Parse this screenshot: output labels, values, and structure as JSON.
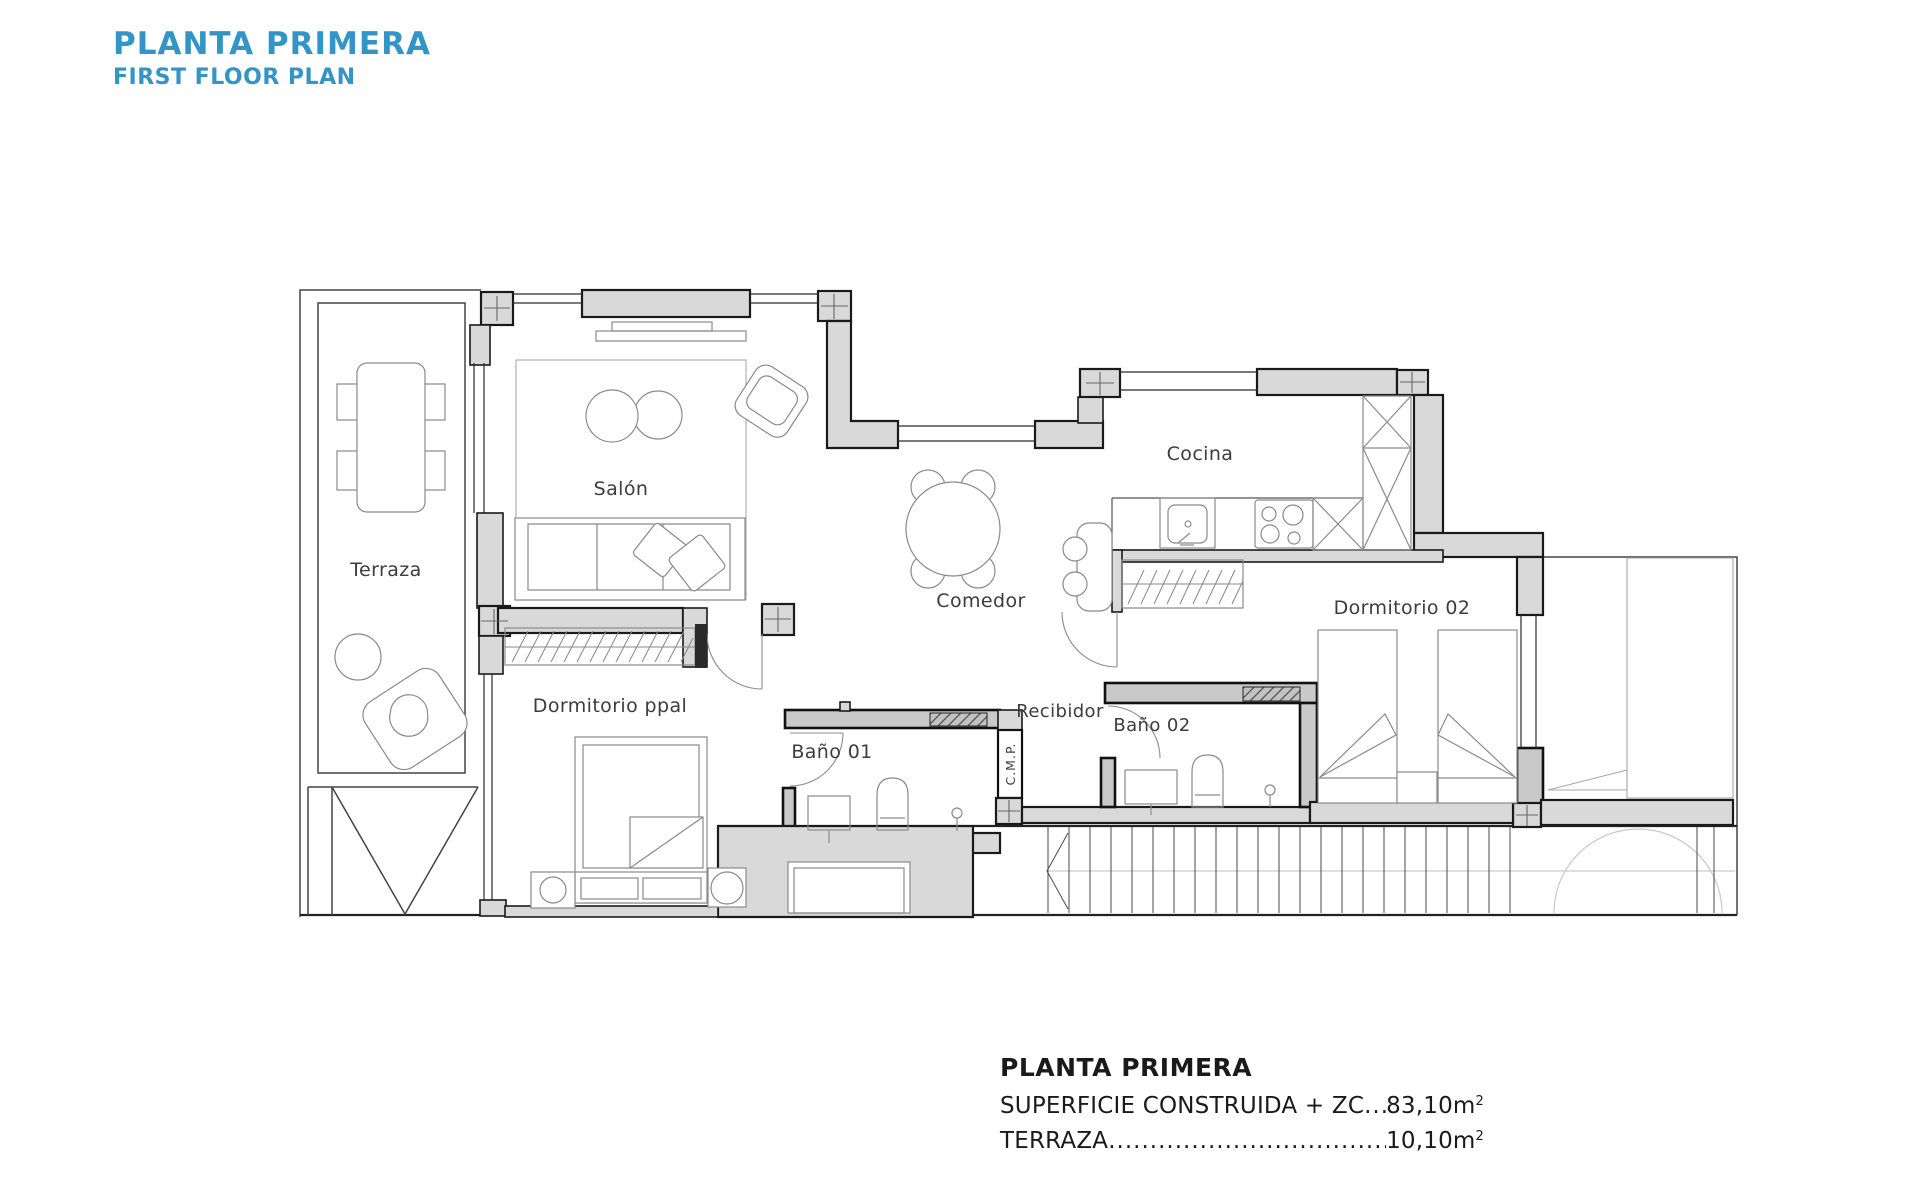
{
  "colors": {
    "accent_blue": "#3394c6",
    "wall_fill": "#d9d9d9",
    "wall_outline": "#1a1a1a",
    "paper": "#ffffff"
  },
  "header": {
    "title": "PLANTA PRIMERA",
    "subtitle": "FIRST FLOOR PLAN"
  },
  "plan": {
    "rooms": {
      "terraza": {
        "label": "Terraza"
      },
      "salon": {
        "label": "Salón"
      },
      "comedor": {
        "label": "Comedor"
      },
      "cocina": {
        "label": "Cocina"
      },
      "dormitorio02": {
        "label": "Dormitorio 02"
      },
      "dormitorioPpal": {
        "label": "Dormitorio ppal"
      },
      "bano01": {
        "label": "Baño 01"
      },
      "recibidor": {
        "label": "Recibidor"
      },
      "bano02": {
        "label": "Baño 02"
      },
      "cmp": {
        "label": "C.M.P."
      }
    }
  },
  "summary": {
    "title": "PLANTA PRIMERA",
    "rows": [
      {
        "label": "SUPERFICIE CONSTRUIDA + ZC",
        "dots": "................................................................................",
        "value": "83,10m",
        "unit_sup": "2"
      },
      {
        "label": "TERRAZA",
        "dots": "................................................................................",
        "value": "10,10m",
        "unit_sup": "2"
      }
    ]
  }
}
